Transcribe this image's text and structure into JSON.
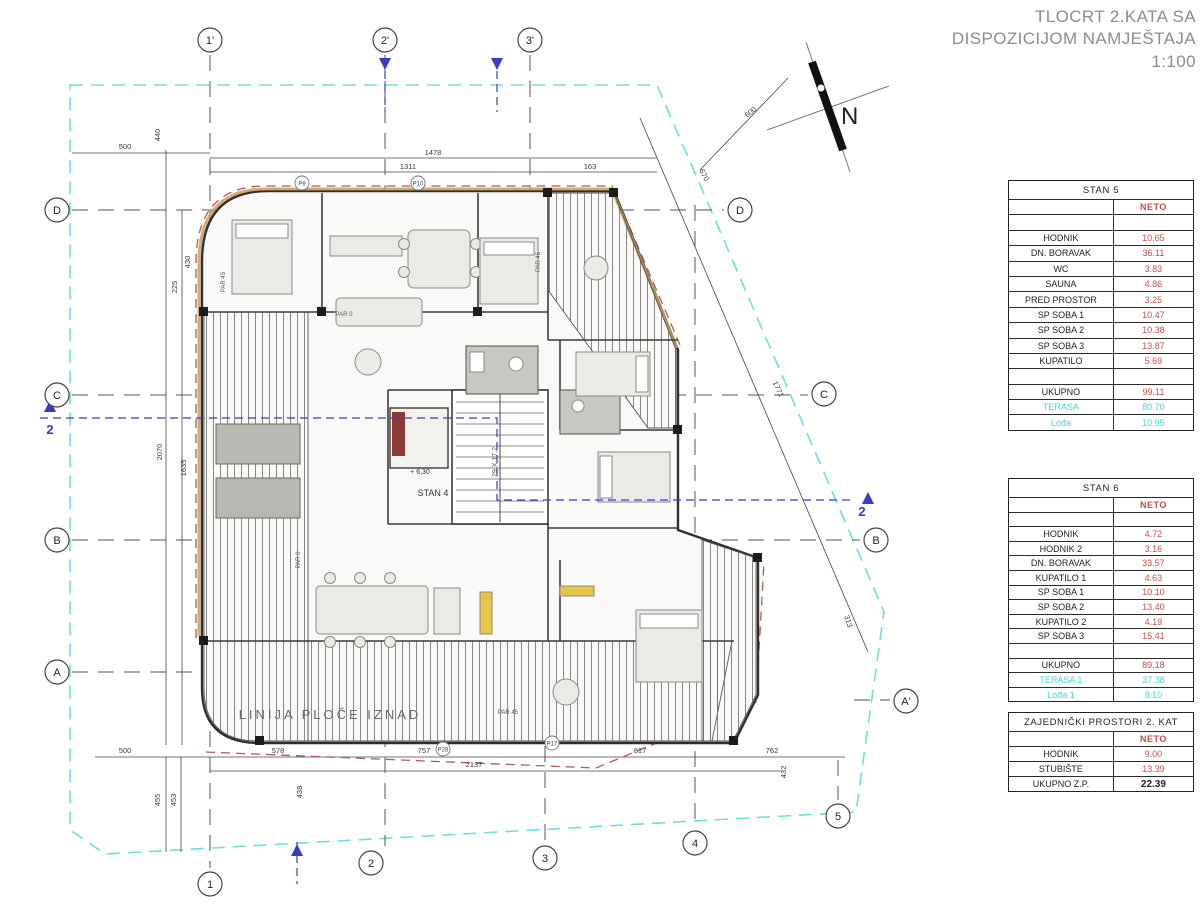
{
  "title": {
    "line1": "TLOCRT 2.KATA SA",
    "line2": "DISPOZICIJOM NAMJEŠTAJA",
    "line3": "1:100"
  },
  "compass": {
    "label": "N"
  },
  "colors": {
    "value_red": "#c0504d",
    "terrace_cyan": "#45d9d5",
    "boundary_cyan": "#6fdede",
    "section_blue": "#3a3ac2",
    "red_dash": "#b25a50",
    "title_gray": "#8c8c8c"
  },
  "tables": [
    {
      "name": "STAN 5",
      "rows": [
        {
          "label": "",
          "value": "NETO",
          "style": "neto"
        },
        {
          "label": "",
          "value": "",
          "style": "spacer"
        },
        {
          "label": "HODNIK",
          "value": "10.65",
          "style": "red"
        },
        {
          "label": "DN. BORAVAK",
          "value": "36.11",
          "style": "red"
        },
        {
          "label": "WC",
          "value": "3.83",
          "style": "red"
        },
        {
          "label": "SAUNA",
          "value": "4.86",
          "style": "red"
        },
        {
          "label": "PRED PROSTOR",
          "value": "3.25",
          "style": "red"
        },
        {
          "label": "SP SOBA 1",
          "value": "10.47",
          "style": "red"
        },
        {
          "label": "SP SOBA 2",
          "value": "10.38",
          "style": "red"
        },
        {
          "label": "SP SOBA 3",
          "value": "13.87",
          "style": "red"
        },
        {
          "label": "KUPATILO",
          "value": "5.69",
          "style": "red"
        },
        {
          "label": "",
          "value": "",
          "style": "spacer"
        },
        {
          "label": "UKUPNO",
          "value": "99.11",
          "style": "red"
        },
        {
          "label": "TERASA",
          "value": "80.70",
          "style": "cyan"
        },
        {
          "label": "Lođa",
          "value": "10.95",
          "style": "cyan"
        }
      ]
    },
    {
      "name": "STAN 6",
      "rows": [
        {
          "label": "",
          "value": "NETO",
          "style": "neto"
        },
        {
          "label": "",
          "value": "",
          "style": "spacer"
        },
        {
          "label": "HODNIK",
          "value": "4.72",
          "style": "red"
        },
        {
          "label": "HODNIK 2",
          "value": "3.16",
          "style": "red"
        },
        {
          "label": "DN. BORAVAK",
          "value": "33.57",
          "style": "red"
        },
        {
          "label": "KUPATILO 1",
          "value": "4.63",
          "style": "red"
        },
        {
          "label": "SP SOBA 1",
          "value": "10.10",
          "style": "red"
        },
        {
          "label": "SP SOBA 2",
          "value": "13.40",
          "style": "red"
        },
        {
          "label": "KUPATILO 2",
          "value": "4.19",
          "style": "red"
        },
        {
          "label": "SP SOBA 3",
          "value": "15.41",
          "style": "red"
        },
        {
          "label": "",
          "value": "",
          "style": "spacer"
        },
        {
          "label": "UKUPNO",
          "value": "89.18",
          "style": "red"
        },
        {
          "label": "TERASA 1",
          "value": "37.38",
          "style": "cyan"
        },
        {
          "label": "Lođa 1",
          "value": "8.10",
          "style": "cyan"
        }
      ]
    },
    {
      "name": "ZAJEDNIČKI PROSTORI 2. KAT",
      "rows": [
        {
          "label": "",
          "value": "NETO",
          "style": "neto"
        },
        {
          "label": "HODNIK",
          "value": "9.00",
          "style": "red"
        },
        {
          "label": "STUBIŠTE",
          "value": "13.39",
          "style": "red"
        },
        {
          "label": "UKUPNO Z.P.",
          "value": "22.39",
          "style": "bold"
        }
      ]
    }
  ],
  "plan": {
    "axis_bubbles": [
      {
        "t": "1'",
        "x": 210,
        "y": 40
      },
      {
        "t": "2'",
        "x": 385,
        "y": 40
      },
      {
        "t": "3'",
        "x": 530,
        "y": 40
      },
      {
        "t": "1",
        "x": 210,
        "y": 884
      },
      {
        "t": "2",
        "x": 371,
        "y": 863
      },
      {
        "t": "3",
        "x": 545,
        "y": 858
      },
      {
        "t": "4",
        "x": 695,
        "y": 843
      },
      {
        "t": "5",
        "x": 838,
        "y": 816
      },
      {
        "t": "D",
        "x": 57,
        "y": 210
      },
      {
        "t": "C",
        "x": 57,
        "y": 395
      },
      {
        "t": "B",
        "x": 57,
        "y": 540
      },
      {
        "t": "A",
        "x": 57,
        "y": 672
      },
      {
        "t": "D",
        "x": 740,
        "y": 210
      },
      {
        "t": "C",
        "x": 824,
        "y": 394
      },
      {
        "t": "B",
        "x": 876,
        "y": 540
      },
      {
        "t": "A'",
        "x": 906,
        "y": 701
      }
    ],
    "p_marks": [
      {
        "t": "P9",
        "x": 302,
        "y": 183
      },
      {
        "t": "P10",
        "x": 418,
        "y": 183
      },
      {
        "t": "P28",
        "x": 443,
        "y": 749
      },
      {
        "t": "P17",
        "x": 552,
        "y": 743
      }
    ],
    "dimensions": [
      {
        "t": "1478",
        "x": 433,
        "y": 155
      },
      {
        "t": "1311",
        "x": 408,
        "y": 169
      },
      {
        "t": "163",
        "x": 590,
        "y": 169
      },
      {
        "t": "500",
        "x": 125,
        "y": 149
      },
      {
        "t": "440",
        "x": 160,
        "y": 135,
        "r": -90
      },
      {
        "t": "430",
        "x": 190,
        "y": 262,
        "r": -90
      },
      {
        "t": "225",
        "x": 177,
        "y": 287,
        "r": -90
      },
      {
        "t": "2070",
        "x": 162,
        "y": 452,
        "r": -90
      },
      {
        "t": "1635",
        "x": 186,
        "y": 468,
        "r": -90
      },
      {
        "t": "500",
        "x": 125,
        "y": 753
      },
      {
        "t": "455",
        "x": 160,
        "y": 800,
        "r": -90
      },
      {
        "t": "453",
        "x": 176,
        "y": 800,
        "r": -90
      },
      {
        "t": "578",
        "x": 278,
        "y": 753
      },
      {
        "t": "757",
        "x": 424,
        "y": 753
      },
      {
        "t": "817",
        "x": 640,
        "y": 753
      },
      {
        "t": "762",
        "x": 772,
        "y": 753
      },
      {
        "t": "2137",
        "x": 474,
        "y": 767
      },
      {
        "t": "438",
        "x": 302,
        "y": 792,
        "r": -90
      },
      {
        "t": "432",
        "x": 786,
        "y": 772,
        "r": -90
      },
      {
        "t": "600",
        "x": 752,
        "y": 114,
        "r": -38
      },
      {
        "t": "670",
        "x": 702,
        "y": 176,
        "r": 63
      },
      {
        "t": "1771",
        "x": 776,
        "y": 390,
        "r": 65
      },
      {
        "t": "313",
        "x": 846,
        "y": 622,
        "r": 72
      }
    ],
    "texts": [
      {
        "t": "LINIJA PLOČE IZNAD",
        "x": 330,
        "y": 719,
        "fs": 13,
        "fill": "#6a6a6a",
        "ls": 3,
        "name": "slab-line-note"
      },
      {
        "t": "STAN 4",
        "x": 433,
        "y": 496,
        "fs": 9,
        "fill": "#333",
        "name": "stan4-label"
      },
      {
        "t": "+ 6,30",
        "x": 420,
        "y": 474,
        "fs": 7,
        "fill": "#333",
        "name": "level-label"
      },
      {
        "t": "29 X 17,2",
        "x": 497,
        "y": 462,
        "fs": 7,
        "fill": "#555",
        "r": -90,
        "name": "stair-riser-label"
      },
      {
        "t": "PAR 45",
        "x": 225,
        "y": 282,
        "fs": 6,
        "fill": "#555",
        "r": -90
      },
      {
        "t": "PAR 45",
        "x": 540,
        "y": 262,
        "fs": 6,
        "fill": "#555",
        "r": -90
      },
      {
        "t": "PAR 0",
        "x": 344,
        "y": 316,
        "fs": 6,
        "fill": "#555"
      },
      {
        "t": "PAR 0",
        "x": 300,
        "y": 560,
        "fs": 6,
        "fill": "#555",
        "r": -90
      },
      {
        "t": "PAR 45",
        "x": 508,
        "y": 714,
        "fs": 6,
        "fill": "#555"
      },
      {
        "t": "2",
        "x": 50,
        "y": 434,
        "fs": 13,
        "fill": "#3a3ac2",
        "bold": true,
        "name": "section-2-label-left"
      },
      {
        "t": "2",
        "x": 862,
        "y": 516,
        "fs": 13,
        "fill": "#3a3ac2",
        "bold": true,
        "name": "section-2-label-right"
      }
    ]
  }
}
